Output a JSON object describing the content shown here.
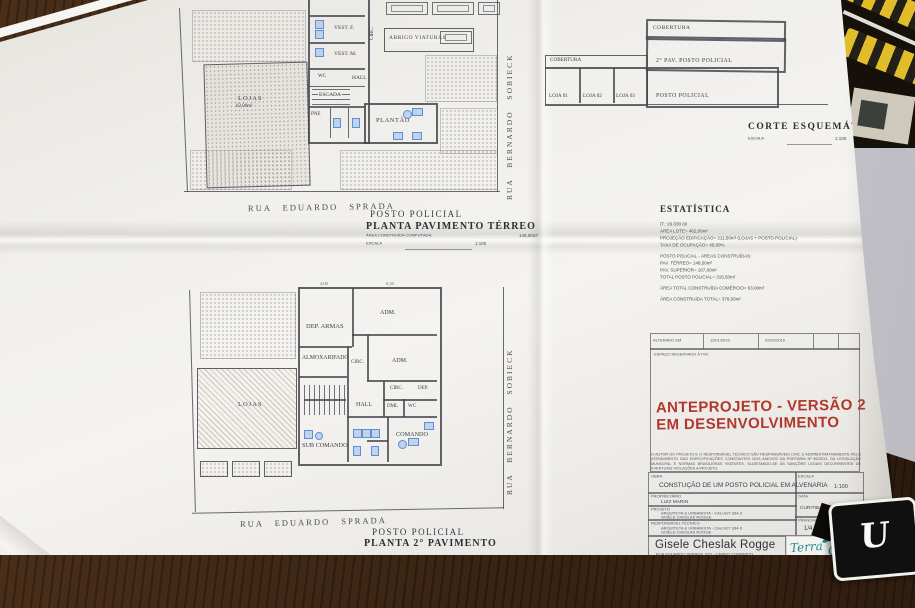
{
  "terreo": {
    "title1": "POSTO POLICIAL",
    "title2": "PLANTA PAVIMENTO TÉRREO",
    "area_label": "ÁREA CONSTRUÍDA COMPUTADA:",
    "area_value": "148,50m²",
    "escala_label": "ESCALA",
    "escala_value": "1:100",
    "street_bottom": "RUA EDUARDO SPRADA",
    "street_right": "RUA BERNARDO SOBIECK",
    "rooms": {
      "lojas": "LOJAS",
      "lojas_area": "63,00m²",
      "vest_f": "VEST. F.",
      "vest_m": "VEST. M.",
      "wc": "WC",
      "hall": "HALL",
      "escada": "ESCADA",
      "pne": "PNE",
      "plantao": "PLANTÃO",
      "circ": "CIRC.",
      "abrigo": "ABRIGO VIATURAS"
    }
  },
  "superior": {
    "title1": "POSTO POLICIAL",
    "title2": "PLANTA 2° PAVIMENTO",
    "street_bottom": "RUA EDUARDO SPRADA",
    "street_right": "RUA BERNARDO SOBIECK",
    "dim_a": "4,00",
    "dim_b": "6,30",
    "rooms": {
      "lojas": "LOJAS",
      "dep_armas": "DEP. ARMAS",
      "adm_top": "ADM.",
      "adm_right": "ADM.",
      "almoxarifado": "ALMOXARIFADO",
      "circ_center": "CIRC.",
      "circ_right": "CIRC.",
      "dep": "DEP.",
      "hall": "HALL",
      "dml": "DML",
      "wc": "WC",
      "sub_comando": "SUB COMANDO",
      "comando": "COMANDO"
    }
  },
  "corte": {
    "title": "CORTE ESQUEMÁTICO",
    "escala_label": "ESCALA",
    "escala_value": "1:100",
    "labels": {
      "cobertura_top": "COBERTURA",
      "cobertura_left": "COBERTURA",
      "pav2": "2° PAV.  POSTO POLICIAL",
      "loja1": "LOJA 01",
      "loja2": "LOJA 02",
      "loja3": "LOJA 03",
      "posto": "POSTO POLICIAL"
    }
  },
  "estatistica": {
    "title": "ESTATÍSTICA",
    "lines": [
      "IT.: 26.030.00",
      "ÁREA LOTE= 462,00m²",
      "PROJEÇÃO EDIFICAÇÃO= 211,50m² (LOJAS + POSTO POLICIAL)",
      "TAXA DE OCUPAÇÃO= 45,80%",
      "",
      "POSTO POLICIAL - ÁREAS CONSTRUÍDAS:",
      "PAV. TÉRREO= 148,50m²",
      "PAV. SUPERIOR= 167,00m²",
      "TOTAL POSTO POLICIAL= 315,50m²",
      "",
      "ÁREA TOTAL CONSTRUÍDA COMÉRCIO= 63,00m²",
      "",
      "ÁREA CONSTRUÍDA TOTAL= 378,50m²"
    ]
  },
  "revisions": {
    "altered_label": "ALTERADO EM",
    "date1": "11/01/2016",
    "date2": "02/02/2016",
    "reserved_note": "ESPAÇO RESERVADO À P.M.",
    "status_line1": "ANTEPROJETO - VERSÃO 2",
    "status_line2": "EM DESENVOLVIMENTO",
    "status_color": "#b0392c"
  },
  "disclaimer": "O AUTOR DO PROJETO E O RESPONSÁVEL TÉCNICO SÃO RESPONSÁVEIS CIVIL E ADMINISTRATIVAMENTE PELO ATENDIMENTO DAS ESPECIFICAÇÕES CONSTANTES NOS ANEXOS DA PORTARIA Nº 80/2013, DA LEGISLAÇÃO MUNICIPAL E NORMAS BRASILEIRAS VIGENTES, SUJEITANDO-SE ÀS SANÇÕES LEGAIS DECORRENTES DE EVENTUAIS VIOLAÇÕES A PROJETO.",
  "titleblock": {
    "obra_label": "OBRA",
    "obra_value": "CONSTUÇÃO DE UM POSTO POLICIAL EM ALVENARIA",
    "escala_label": "ESCALA",
    "escala_value": "1:100",
    "proprietario_label": "PROPRIETÁRIO",
    "proprietario_value": "LUIZ MARIN",
    "data_label": "DATA",
    "data_value": "CURITIBA   02/04/2016",
    "projeto_label": "PROJETO",
    "projeto_line1": "ARQUITETA & URBANISTA - CAU A27.394-3",
    "projeto_line2": "GISELE CHESLAK ROGGE",
    "resp_label": "RESPONSÁVEL TÉCNICO",
    "resp_line1": "ARQUITETA & URBANISTA - CAU A27.394-3",
    "resp_line2": "GISELE CHESLAK ROGGE",
    "prancha_label": "PRANCHA",
    "prancha_value": "1/4",
    "firm_name": "Gisele Cheslak Rogge",
    "firm_line1": "RUA EDUARDO SPRADA, 870 - CAMPO COMPRIDO",
    "firm_line2": "81.230-190 - CURITIBA / PR",
    "firm_line3": "(41) 3274-0000 - ARQUITETURA E URBANISMO"
  },
  "logo": {
    "word1": "Terra",
    "word2": "Cruz",
    "teal": "#1f8a8a"
  },
  "desk": {
    "card_letter": "U"
  }
}
